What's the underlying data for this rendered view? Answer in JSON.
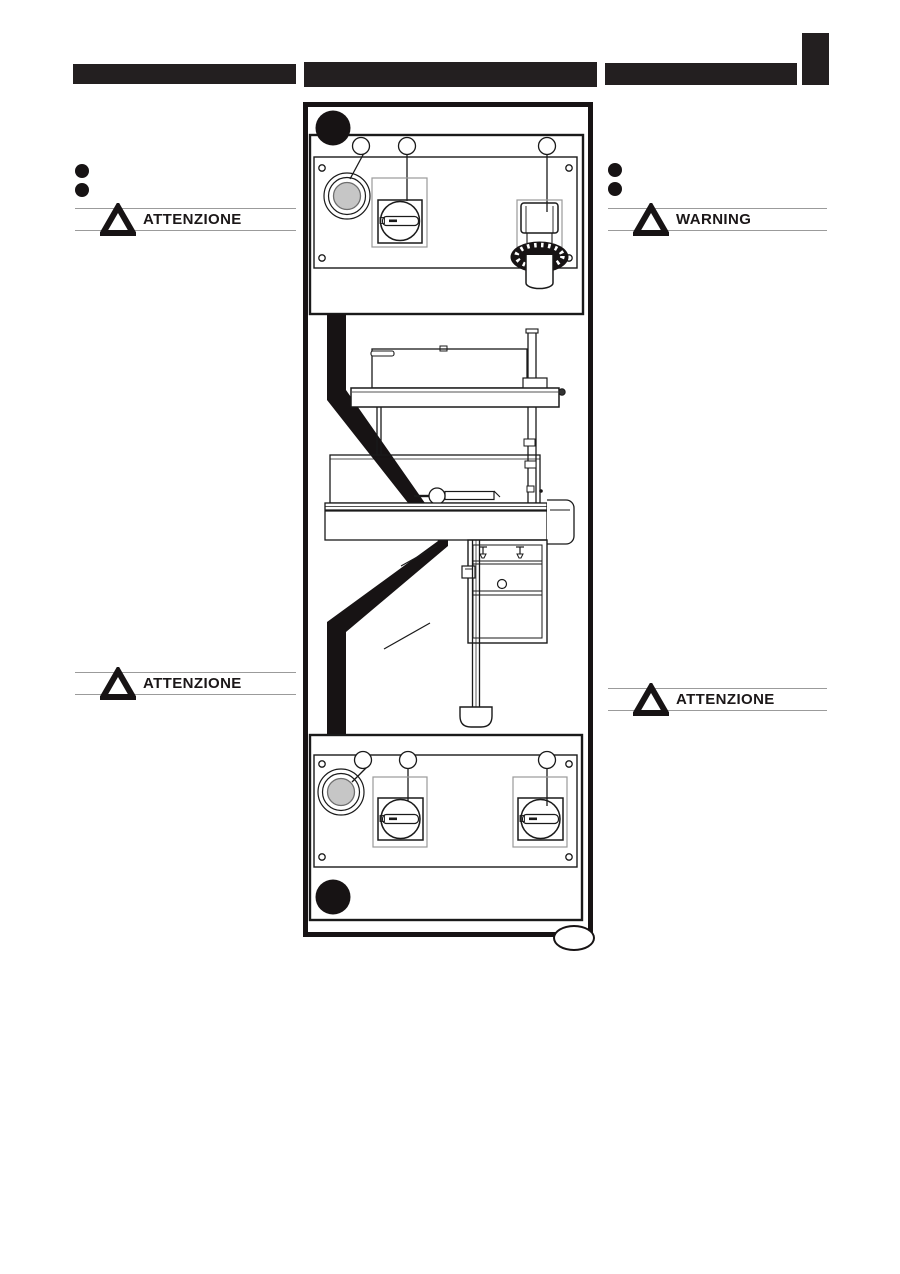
{
  "page": {
    "type": "machine-manual-page",
    "background": "#ffffff",
    "ink_color": "#231f20"
  },
  "header": {
    "bars": [
      {
        "name": "left-section-bar",
        "text": ""
      },
      {
        "name": "center-section-bar",
        "text": ""
      },
      {
        "name": "right-section-bar",
        "text": ""
      }
    ],
    "corner_block": {
      "present": true,
      "color": "#231f20"
    }
  },
  "left_column": {
    "bullet_count": 2,
    "warning_top": "ATTENZIONE",
    "warning_bottom": "ATTENZIONE"
  },
  "right_column": {
    "bullet_count": 2,
    "warning_top": "WARNING",
    "warning_bottom": "ATTENZIONE"
  },
  "warnings": {
    "left_top": "ATTENZIONE",
    "right_top": "WARNING",
    "left_bottom": "ATTENZIONE",
    "right_bottom": "ATTENZIONE"
  },
  "figure": {
    "description": "machine control panels diagram",
    "badges": [
      {
        "position": "top-left-of-upper-panel",
        "style": "solid-black-circle"
      },
      {
        "position": "bottom-left-of-lower-panel",
        "style": "solid-black-circle"
      }
    ],
    "upper_panel": {
      "callout_count": 3,
      "controls": [
        "emergency-stop-button",
        "main-rotary-switch",
        "adjustment-knob"
      ],
      "screw_count": 4
    },
    "lower_panel": {
      "callout_count": 3,
      "controls": [
        "emergency-stop-button",
        "rotary-switch",
        "rotary-switch"
      ],
      "screw_count": 4
    },
    "pointer_band": "black chevron linking both panels to machine mid-point",
    "colors": {
      "estop_button_fill": "#c6c6c6",
      "panel_light_outline": "#9a9a9a",
      "line_ink": "#1a1a1a"
    }
  }
}
